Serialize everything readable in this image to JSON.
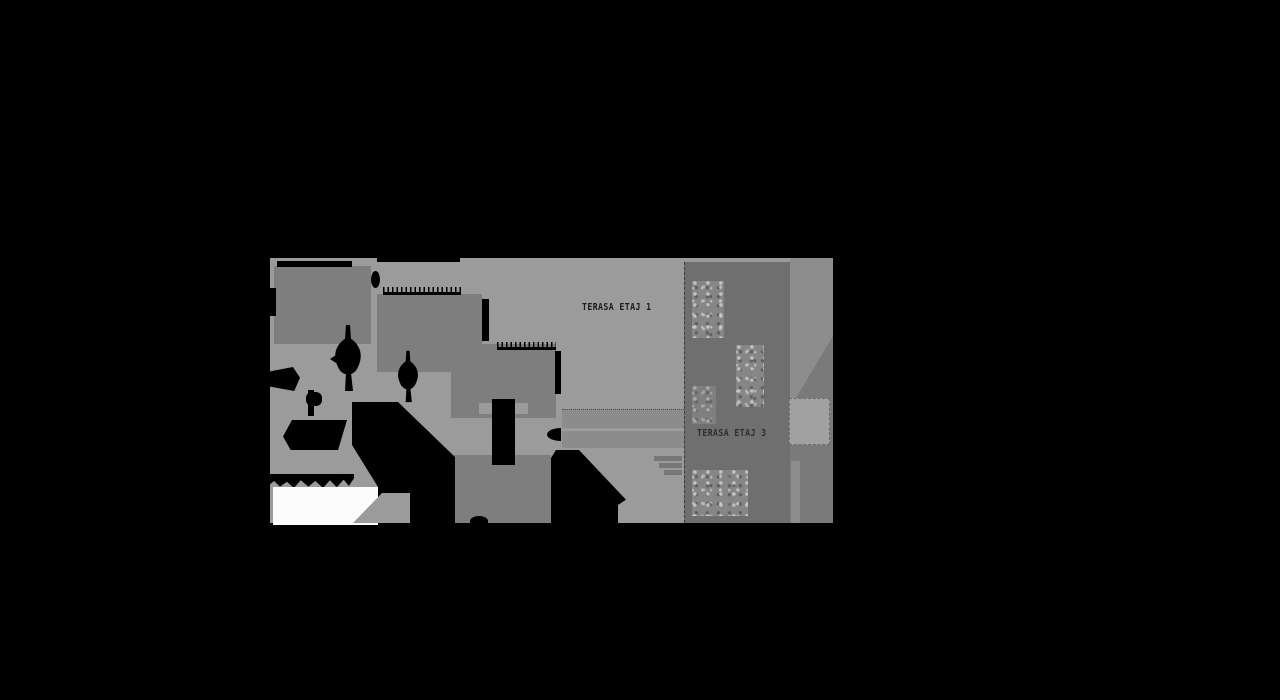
{
  "document": {
    "type": "architectural-roof-plan",
    "background_color": "#000000"
  },
  "palette": {
    "bg": "#000000",
    "base": "#9b9b9b",
    "roof": "#7e7e7e",
    "ink": "#000000",
    "strip": "#6f6f6f",
    "col": "#7a7a7a",
    "col-light": "#8d8d8d",
    "band": "#8c8c8c",
    "sky": "#a1a1a1",
    "white": "#fcfcfc",
    "foliage": "#868686",
    "glyph": "#777777",
    "label1": "#1a1a1a",
    "label3": "#2e2e2e"
  },
  "plan": {
    "labels": {
      "terrace1": "TERASA ETAJ 1",
      "terrace3": "TERASA ETAJ 3"
    },
    "regions": [
      "terrace-floor-1-deck",
      "terrace-floor-3-deck",
      "roof-block-upper-left",
      "roof-block-upper-mid",
      "roof-block-center",
      "roof-block-lower-center",
      "stair-core",
      "planter-boxes",
      "trees",
      "cast-shadows"
    ]
  }
}
